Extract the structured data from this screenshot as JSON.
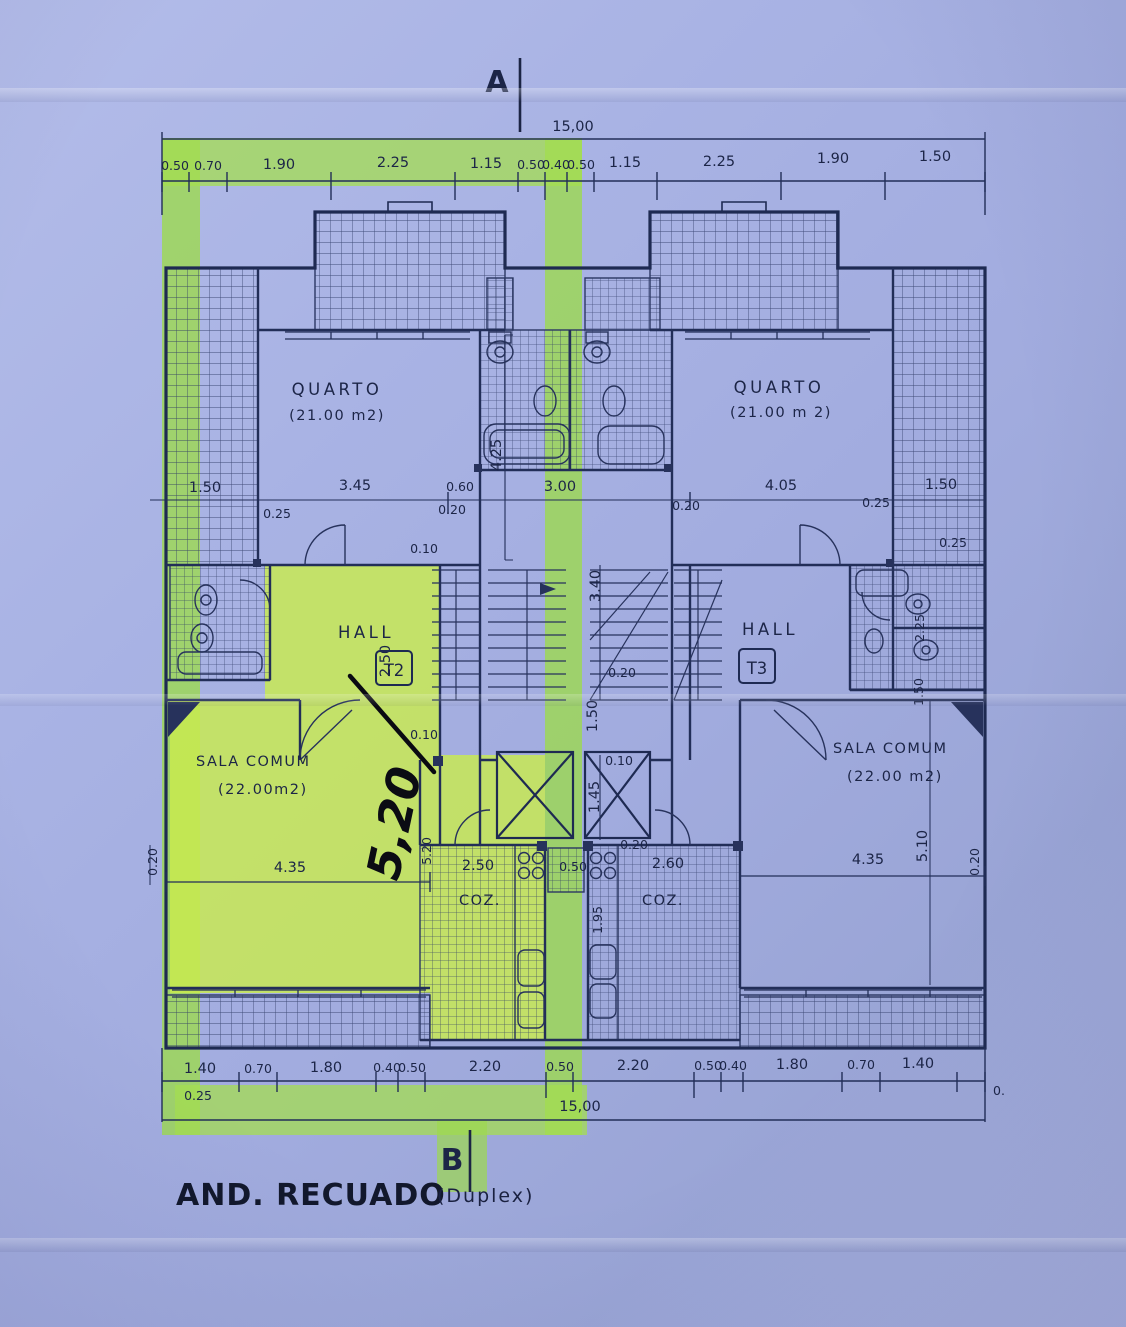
{
  "markers": {
    "a": "A",
    "b": "B"
  },
  "title": {
    "main": "AND. RECUADO",
    "sub": "(Duplex)"
  },
  "rooms": {
    "quartoL": {
      "name": "QUARTO",
      "area": "(21.00 m2)"
    },
    "quartoR": {
      "name": "QUARTO",
      "area": "(21.00 m 2)"
    },
    "hallL": {
      "name": "HALL",
      "unit": "T2"
    },
    "hallR": {
      "name": "HALL",
      "unit": "T3"
    },
    "salaL": {
      "name": "SALA COMUM",
      "area": "(22.00m2)"
    },
    "salaR": {
      "name": "SALA COMUM",
      "area": "(22.00 m2)"
    },
    "cozL": {
      "name": "COZ."
    },
    "cozR": {
      "name": "COZ."
    }
  },
  "handwritten": {
    "value": "5,20"
  },
  "dims": {
    "total_top": "15,00",
    "total_bottom": "15,00",
    "top_row": [
      "0.50",
      "0.70",
      "1.90",
      "2.25",
      "1.15",
      "0.50",
      "0.40",
      "0.50",
      "1.15",
      "2.25",
      "1.90",
      "1.50"
    ],
    "bottom_row": [
      "1.40",
      "0.70",
      "1.80",
      "0.40",
      "0.50",
      "2.20",
      "0.50",
      "2.20",
      "0.50",
      "0.40",
      "1.80",
      "0.70",
      "1.40"
    ],
    "bottom_trail": "0.",
    "b025": "0.25",
    "m150l": "1.50",
    "m025a": "0.25",
    "m345": "3.45",
    "m060": "0.60",
    "m020a": "0.20",
    "m300": "3.00",
    "m020b": "0.20",
    "m405": "4.05",
    "m025b": "0.25",
    "m150r": "1.50",
    "m025c": "0.25",
    "m010a": "0.10",
    "v425": "4.25",
    "v340": "3.40",
    "v250": "2.50",
    "v150c": "1.50",
    "v145": "1.45",
    "v225": "2.25",
    "v150r": "1.50",
    "v520": "5.20",
    "v020l": "0.20",
    "v510": "5.10",
    "v020r": "0.20",
    "v195": "1.95",
    "k250": "2.50",
    "k050": "0.50",
    "k260": "2.60",
    "k020": "0.20",
    "s010a": "0.10",
    "s010b": "0.10",
    "c020": "0.20",
    "l435a": "4.35",
    "l435b": "4.35"
  }
}
